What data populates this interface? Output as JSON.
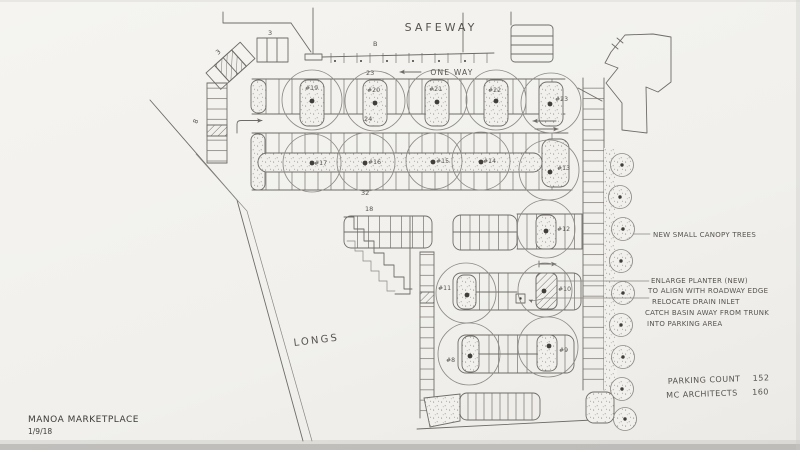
{
  "plan": {
    "stores": {
      "safeway": "SAFEWAY",
      "longs": "LONGS"
    },
    "traffic": {
      "one_way": "ONE WAY"
    },
    "titleblock": {
      "project": "MANOA MARKETPLACE",
      "date": "1/9/18"
    },
    "summary": {
      "parking_count_label": "PARKING COUNT",
      "parking_count_value": "152",
      "architects_label": "MC ARCHITECTS",
      "architects_value": "160"
    },
    "notes": {
      "new_trees": "NEW SMALL CANOPY TREES",
      "enlarge1": "ENLARGE PLANTER (NEW)",
      "enlarge2": "TO ALIGN WITH ROADWAY EDGE",
      "relocate1": "RELOCATE DRAIN INLET",
      "relocate2": "CATCH BASIN AWAY FROM TRUNK",
      "relocate3": "INTO PARKING AREA"
    },
    "trees": {
      "row1": [
        "#19",
        "#20",
        "#21",
        "#22",
        "#23"
      ],
      "row2": [
        "#17",
        "#16",
        "#15",
        "#14",
        "#13"
      ],
      "t12": "#12",
      "t11": "#11",
      "t10": "#10",
      "t9": "#9",
      "t8": "#8"
    },
    "counts": {
      "row_top": "23",
      "row_mid": "24",
      "row_lower": "32",
      "row_18": "18",
      "left_col": "8",
      "block_a": "3",
      "block_b": "3",
      "door": "B"
    },
    "colors": {
      "paper": "#f1f0ec",
      "pencil": "#6f6c67",
      "pencil_light": "#8a8783"
    }
  }
}
